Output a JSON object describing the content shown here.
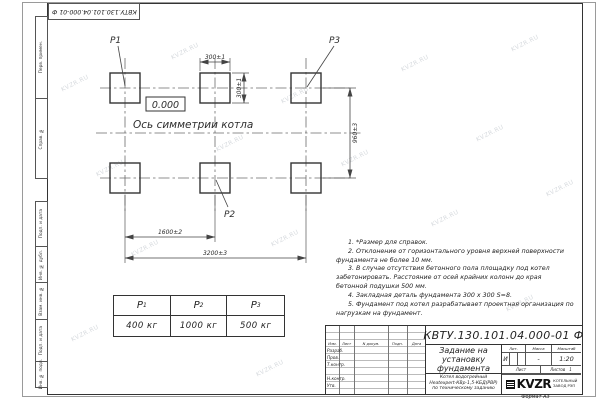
{
  "sheet": {
    "top_stamp": "КВТУ.130.101.04.000-01 Ф",
    "format_label": "Формат А3",
    "watermark": "KVZR.RU",
    "left_labels": {
      "perv": "Перв. примен.",
      "sprav": "Справ. №",
      "podp1": "Подп. и дата",
      "inv_dubl": "Инв. № дубл.",
      "vzam": "Взам. инв. №",
      "podp2": "Подп. и дата",
      "inv_podl": "Инв. № подл."
    }
  },
  "plan": {
    "p1": "Р1",
    "p2": "Р2",
    "p3": "Р3",
    "elevation": "0.000",
    "axis_label": "Ось симметрии котла",
    "dim_pad_w": "300±1",
    "dim_pad_h": "300±1",
    "dim_rows": "960±3",
    "dim_mid": "1600±2",
    "dim_total": "3200±3"
  },
  "notes": [
    "1. *Размер для справок.",
    "2. Отклонение от горизонтального уровня верхней поверхности фундамента не более 10 мм.",
    "3. В случае отсутствия бетонного пола площадку под котел забетонировать. Расстояние от осей крайних колонн до края бетонной подушки 500 мм.",
    "4. Закладная деталь фундамента 300 x 300 S=8.",
    "5. Фундамент под котел разрабатывает проектная организация по нагрузкам на фундамент."
  ],
  "load_table": {
    "cols": [
      {
        "name": "Р",
        "sub": "1",
        "value": "400 кг"
      },
      {
        "name": "Р",
        "sub": "2",
        "value": "1000 кг"
      },
      {
        "name": "Р",
        "sub": "3",
        "value": "500 кг"
      }
    ]
  },
  "title_block": {
    "doc_number": "КВТУ.130.101.04.000-01 Ф",
    "title_lines": [
      "Задание на",
      "установку",
      "фундамента"
    ],
    "product_lines": [
      "Котел водогрейный",
      "Heatexpert-КВр-1,5-КБД(РВР)",
      "по техническому заданию"
    ],
    "header_cols": [
      "Изм.",
      "Лист",
      "N докум.",
      "Подп.",
      "Дата"
    ],
    "row_labels": [
      "Разраб.",
      "Пров.",
      "Т.контр.",
      "Н.контр.",
      "Утв."
    ],
    "lit_header": "Лит.",
    "mass_header": "Масса",
    "scale_header": "Масштаб",
    "lit_value": "И",
    "mass_value": "-",
    "scale_value": "1:20",
    "sheet_label": "Лист",
    "sheets_label": "Листов",
    "sheets_value": "1",
    "logo_text": "KVZR",
    "factory_line1": "КОТЕЛЬНЫЙ",
    "factory_line2": "ЗАВОД РЭП"
  }
}
